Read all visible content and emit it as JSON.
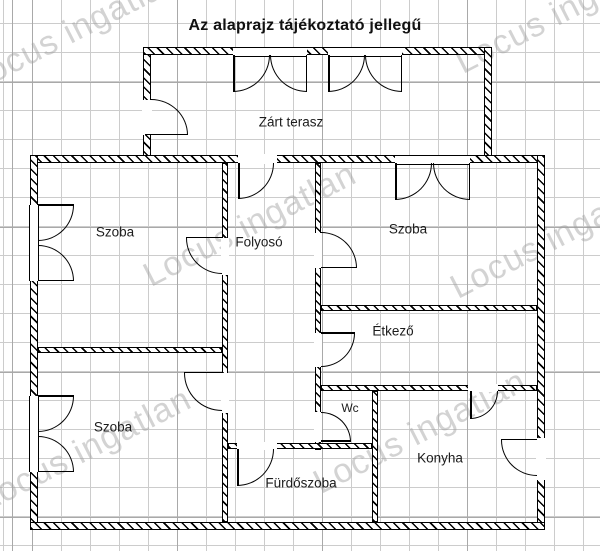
{
  "title": "Az alaprajz tájékoztató jellegű",
  "watermark": "Locus ingatlan",
  "rooms": {
    "terrace": "Zárt terasz",
    "room_top_left": "Szoba",
    "hallway": "Folyosó",
    "room_top_right": "Szoba",
    "dining": "Étkező",
    "room_bottom_left": "Szoba",
    "wc": "Wc",
    "kitchen": "Konyha",
    "bathroom": "Fürdőszoba"
  },
  "colors": {
    "wall": "#000000",
    "grid_minor": "#cccccc",
    "grid_major": "#a9a9a9",
    "watermark": "#9e9e9e",
    "text": "#1c1c1c"
  }
}
